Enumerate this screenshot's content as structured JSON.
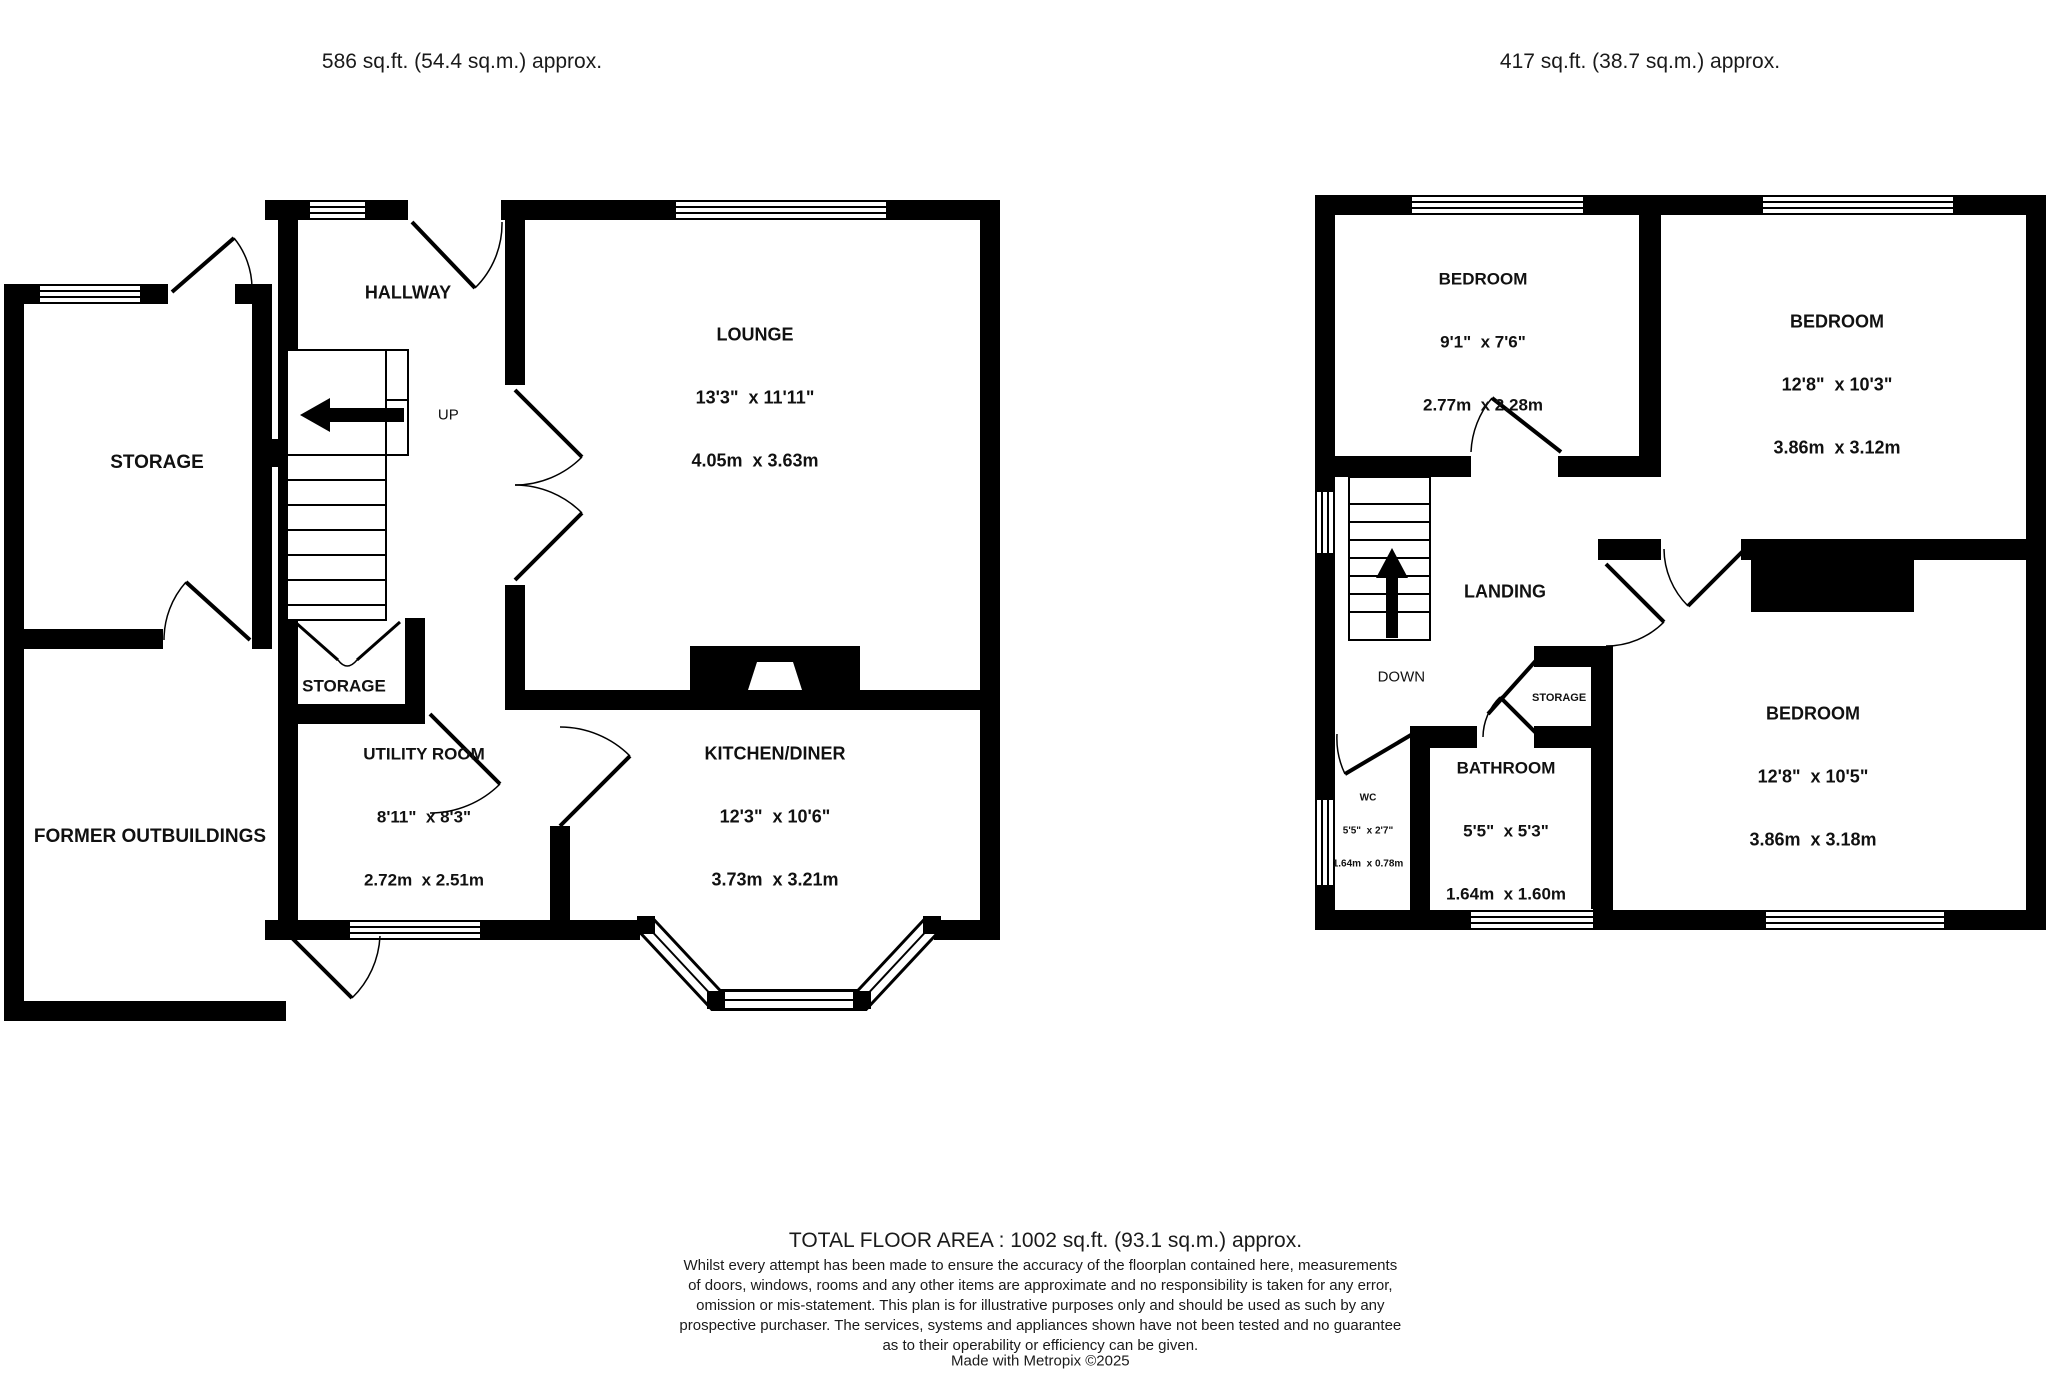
{
  "ground_floor": {
    "title": "GROUND FLOOR",
    "area": "586 sq.ft. (54.4 sq.m.) approx.",
    "rooms": {
      "hallway": {
        "name": "HALLWAY"
      },
      "lounge": {
        "name": "LOUNGE",
        "imperial": "13'3\"  x 11'11\"",
        "metric": "4.05m  x 3.63m"
      },
      "storage_annex": {
        "name": "STORAGE"
      },
      "former_outbuildings": {
        "name": "FORMER OUTBUILDINGS"
      },
      "storage_under_stairs": {
        "name": "STORAGE"
      },
      "utility": {
        "name": "UTILITY ROOM",
        "imperial": "8'11\"  x 8'3\"",
        "metric": "2.72m  x 2.51m"
      },
      "kitchen": {
        "name": "KITCHEN/DINER",
        "imperial": "12'3\"  x 10'6\"",
        "metric": "3.73m  x 3.21m"
      }
    },
    "stair_label": "UP"
  },
  "first_floor": {
    "title": "1ST FLOOR",
    "area": "417 sq.ft. (38.7 sq.m.) approx.",
    "rooms": {
      "bedroom1": {
        "name": "BEDROOM",
        "imperial": "9'1\"  x 7'6\"",
        "metric": "2.77m  x 2.28m"
      },
      "bedroom2": {
        "name": "BEDROOM",
        "imperial": "12'8\"  x 10'3\"",
        "metric": "3.86m  x 3.12m"
      },
      "bedroom3": {
        "name": "BEDROOM",
        "imperial": "12'8\"  x 10'5\"",
        "metric": "3.86m  x 3.18m"
      },
      "bathroom": {
        "name": "BATHROOM",
        "imperial": "5'5\"  x 5'3\"",
        "metric": "1.64m  x 1.60m"
      },
      "wc": {
        "name": "WC",
        "imperial": "5'5\"  x 2'7\"",
        "metric": "1.64m  x 0.78m"
      },
      "landing": {
        "name": "LANDING"
      },
      "storage": {
        "name": "STORAGE"
      }
    },
    "stair_label": "DOWN"
  },
  "footer": {
    "total": "TOTAL FLOOR AREA : 1002 sq.ft. (93.1 sq.m.) approx.",
    "disclaimer_lines": [
      "Whilst every attempt has been made to ensure the accuracy of the floorplan contained here, measurements",
      "of doors, windows, rooms and any other items are approximate and no responsibility is taken for any error,",
      "omission or mis-statement. This plan is for illustrative purposes only and should be used as such by any",
      "prospective purchaser. The services, systems and appliances shown have not been tested and no guarantee",
      "as to their operability or efficiency can be given."
    ],
    "credit": "Made with Metropix ©2025"
  },
  "colors": {
    "wall": "#000000",
    "background": "#ffffff",
    "text": "#111111"
  }
}
